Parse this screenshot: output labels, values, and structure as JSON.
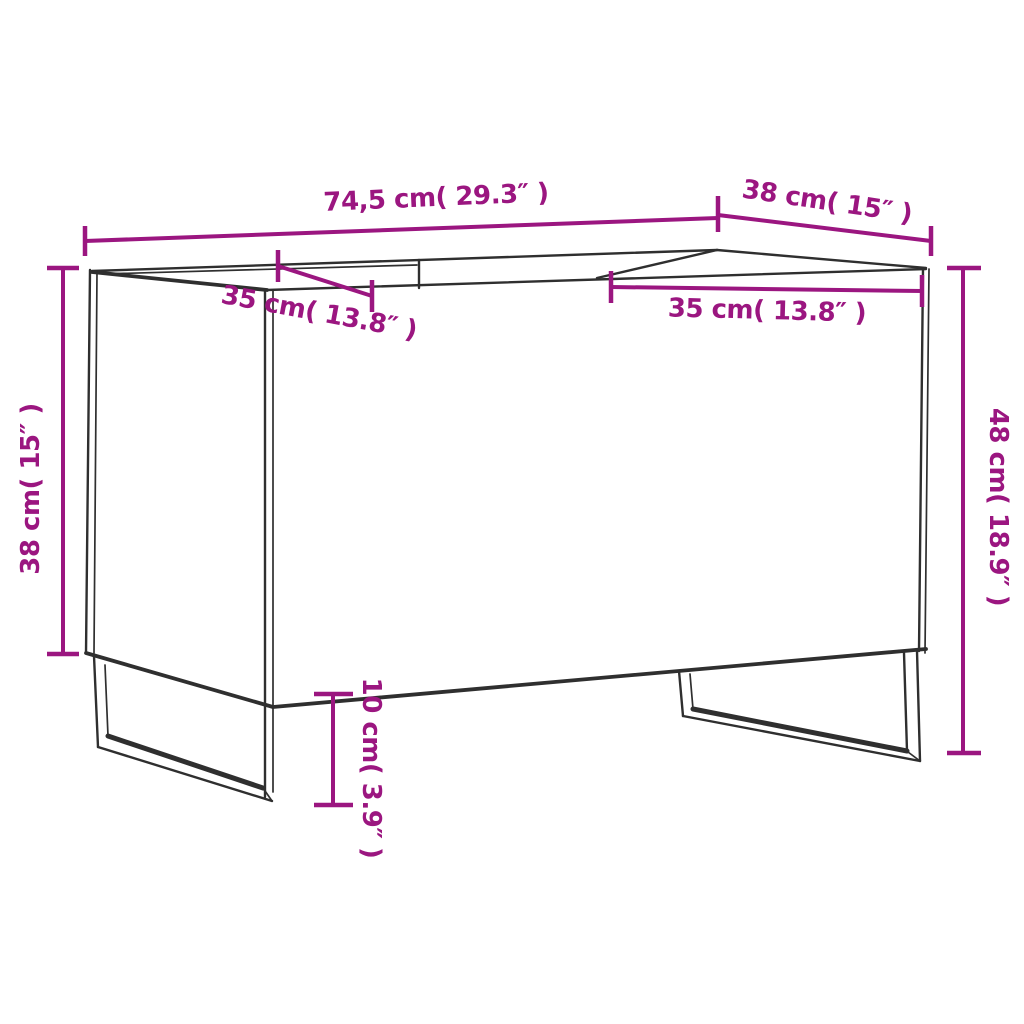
{
  "page": {
    "background": "#ffffff"
  },
  "diagram": {
    "type": "technical-dimension-drawing",
    "subject": "record cabinet with open top, two compartments and sled legs",
    "colors": {
      "dimension": "#9B1680",
      "outline": "#2f2f2f",
      "background": "#ffffff"
    },
    "dimensions": {
      "width": {
        "cm": "74,5",
        "inches": "29.3",
        "label": "74,5 cm( 29.3″ )"
      },
      "depth": {
        "cm": "38",
        "inches": "15",
        "label": "38 cm( 15″ )"
      },
      "compartment_left": {
        "cm": "35",
        "inches": "13.8",
        "label": "35 cm( 13.8″ )"
      },
      "compartment_right": {
        "cm": "35",
        "inches": "13.8",
        "label": "35 cm( 13.8″ )"
      },
      "side_height": {
        "cm": "38",
        "inches": "15",
        "label": "38 cm( 15″ )"
      },
      "overall_height": {
        "cm": "48",
        "inches": "18.9",
        "label": "48 cm( 18.9″ )"
      },
      "leg_height": {
        "cm": "10",
        "inches": "3.9",
        "label": "10 cm( 3.9″ )"
      }
    }
  }
}
